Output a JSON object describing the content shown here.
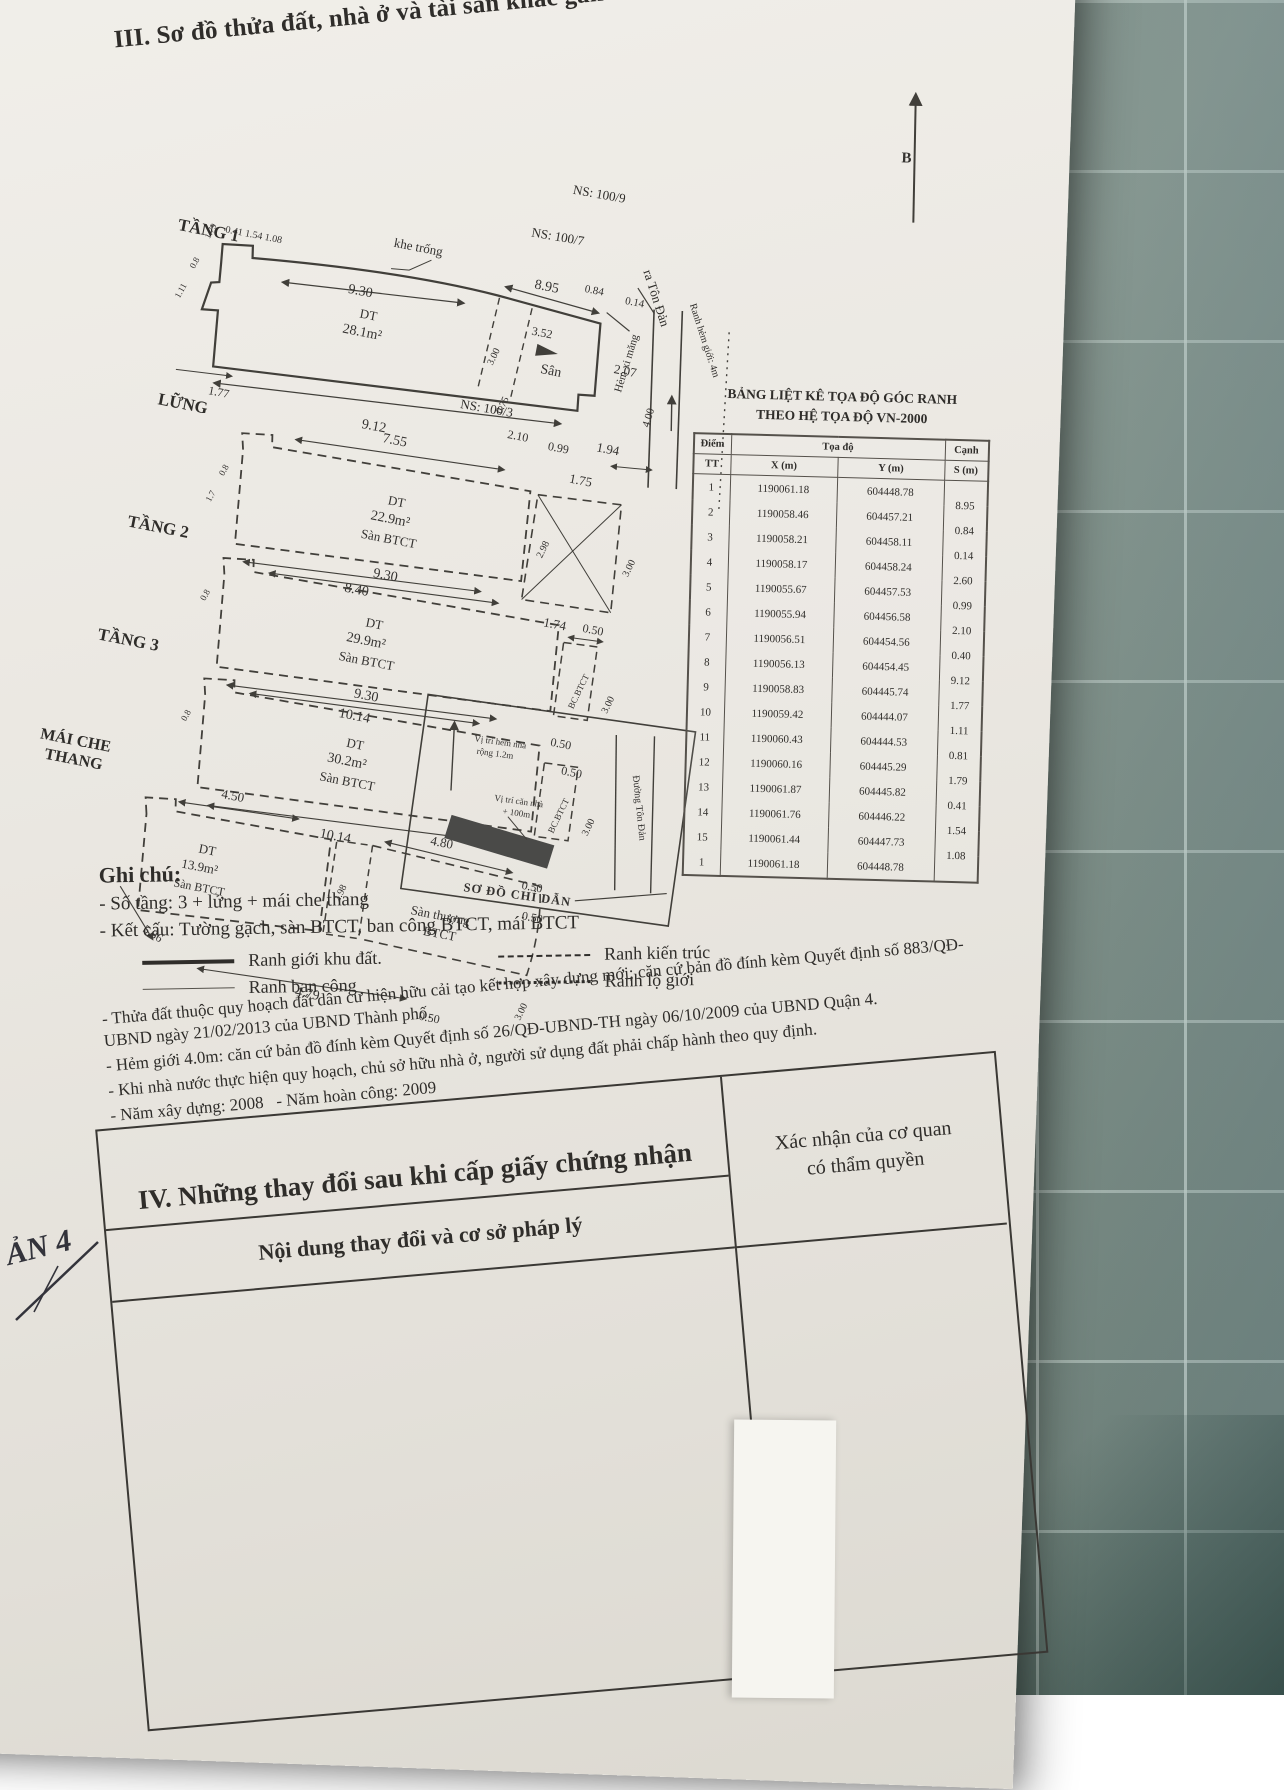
{
  "header": {
    "title": "III. Sơ đồ thửa đất, nhà ở và tài sản khác gắn liền với đất",
    "north_label": "B"
  },
  "site": {
    "khe_trong": "khe trống",
    "ns_100_9": "NS: 100/9",
    "ns_100_7": "NS: 100/7",
    "ns_100_3": "NS: 100/3",
    "ra_ton_dan": "ra Tôn Đản",
    "ranh_hem": "Ranh hẻm giới: 4m",
    "hem_xi_mang": "Hẻm xi măng",
    "hem_width": "4.00"
  },
  "floors": [
    {
      "name": "TẦNG 1",
      "dt": "DT",
      "area": "28.1m²",
      "dims": {
        "jog": "0.41  1.54  1.08",
        "top_a": "9.30",
        "top_b": "8.95",
        "left_a": "1.79",
        "left_b": "0.8",
        "left_c": "1.11",
        "left_d": "1.77",
        "bottom": "9.12",
        "san": "Sân",
        "r352": "3.52",
        "r084": "0.84",
        "r014": "0.14",
        "r207": "2.07",
        "r300": "3.00",
        "r075": "0.75",
        "r210": "2.10",
        "r099": "0.99",
        "r194": "1.94"
      }
    },
    {
      "name": "LỮNG",
      "dt": "DT",
      "area": "22.9m²",
      "slab": "Sàn BTCT",
      "dims": {
        "top": "7.55",
        "r175": "1.75",
        "r298": "2.98",
        "r300": "3.00",
        "r174": "1.74",
        "bottom": "8.40",
        "left_a": "0.8",
        "left_b": "1.7"
      }
    },
    {
      "name": "TẦNG 2",
      "dt": "DT",
      "area": "29.9m²",
      "slab": "Sàn BTCT",
      "dims": {
        "top": "9.30",
        "r050": "0.50",
        "bc": "BC.BTCT",
        "r300": "3.00",
        "bottom": "10.14",
        "left_a": "0.8"
      }
    },
    {
      "name": "TẦNG 3",
      "dt": "DT",
      "area": "30.2m²",
      "slab": "Sàn BTCT",
      "dims": {
        "top": "9.30",
        "r050a": "0.50",
        "r050b": "0.50",
        "bc": "BC.BTCT",
        "r300": "3.00",
        "bottom": "10.14",
        "left_a": "0.8"
      }
    },
    {
      "name": "MÁI CHE THANG",
      "name_l1": "MÁI CHE",
      "name_l2": "THANG",
      "dt": "DT",
      "area": "13.9m²",
      "slab": "Sàn BTCT",
      "terrace_l1": "Sàn thượng",
      "terrace_l2": "BTCT",
      "dims": {
        "top": "4.50",
        "mid": "4.80",
        "r050a": "0.50",
        "r050b": "0.50",
        "shaft": "2.98",
        "left": "5.36",
        "bottom": "4.79",
        "bottom_b": "0.50",
        "r300": "3.00"
      }
    }
  ],
  "inset": {
    "caption": "SƠ ĐỒ CHỈ DẪN",
    "street": "Đường Tôn Đản",
    "note_alley_l1": "Vị trí hẻm nhà",
    "note_alley_l2": "rộng 1.2m",
    "note_house_l1": "Vị trí căn nhà",
    "note_house_l2": "+ 100m"
  },
  "coord_table": {
    "title_l1": "BẢNG LIỆT KÊ TỌA ĐỘ GÓC RANH",
    "title_l2": "THEO HỆ TỌA ĐỘ VN-2000",
    "col_point": "Điểm",
    "col_coord": "Tọa độ",
    "col_edge": "Cạnh",
    "col_tt": "TT",
    "col_x": "X (m)",
    "col_y": "Y (m)",
    "col_s": "S (m)",
    "rows": [
      {
        "tt": "1",
        "x": "1190061.18",
        "y": "604448.78",
        "s": "8.95"
      },
      {
        "tt": "2",
        "x": "1190058.46",
        "y": "604457.21",
        "s": "0.84"
      },
      {
        "tt": "3",
        "x": "1190058.21",
        "y": "604458.11",
        "s": "0.14"
      },
      {
        "tt": "4",
        "x": "1190058.17",
        "y": "604458.24",
        "s": "2.60"
      },
      {
        "tt": "5",
        "x": "1190055.67",
        "y": "604457.53",
        "s": "0.99"
      },
      {
        "tt": "6",
        "x": "1190055.94",
        "y": "604456.58",
        "s": "2.10"
      },
      {
        "tt": "7",
        "x": "1190056.51",
        "y": "604454.56",
        "s": "0.40"
      },
      {
        "tt": "8",
        "x": "1190056.13",
        "y": "604454.45",
        "s": "9.12"
      },
      {
        "tt": "9",
        "x": "1190058.83",
        "y": "604445.74",
        "s": "1.77"
      },
      {
        "tt": "10",
        "x": "1190059.42",
        "y": "604444.07",
        "s": "1.11"
      },
      {
        "tt": "11",
        "x": "1190060.43",
        "y": "604444.53",
        "s": "0.81"
      },
      {
        "tt": "12",
        "x": "1190060.16",
        "y": "604445.29",
        "s": "1.79"
      },
      {
        "tt": "13",
        "x": "1190061.87",
        "y": "604445.82",
        "s": "0.41"
      },
      {
        "tt": "14",
        "x": "1190061.76",
        "y": "604446.22",
        "s": "1.54"
      },
      {
        "tt": "15",
        "x": "1190061.44",
        "y": "604447.73",
        "s": "1.08"
      },
      {
        "tt": "1",
        "x": "1190061.18",
        "y": "604448.78",
        "s": ""
      }
    ]
  },
  "notes": {
    "title": "Ghi chú:",
    "line_floors": "- Số tầng: 3 + lửng + mái che thang",
    "line_structure": "- Kết cấu: Tường gạch, sàn BTCT, ban công BTCT, mái BTCT",
    "legend": {
      "boundary": "Ranh giới khu đất.",
      "architecture": "Ranh kiến trúc",
      "balcony": "Ranh ban công",
      "road": "Ranh lộ giới"
    },
    "para_zoning": "- Thửa đất thuộc quy hoạch đất dân cư hiện hữu cải tạo kết hợp xây dựng mới; căn cứ bản đồ đính kèm Quyết định số 883/QĐ-UBND ngày 21/02/2013 của UBND Thành phố.",
    "para_alley": "- Hẻm giới 4.0m: căn cứ bản đồ đính kèm Quyết định số 26/QĐ-UBND-TH ngày 06/10/2009 của UBND Quận 4.",
    "para_comply": "- Khi nhà nước thực hiện quy hoạch, chủ sở hữu nhà ở, người sử dụng đất phải chấp hành theo quy định.",
    "para_year": "- Năm xây dựng: 2008   - Năm hoàn công: 2009"
  },
  "section4": {
    "title": "IV. Những thay đổi sau khi cấp giấy chứng nhận",
    "confirm_l1": "Xác nhận của cơ quan",
    "confirm_l2": "có thẩm quyền",
    "content_header": "Nội dung thay đổi và cơ sở pháp lý"
  },
  "handwriting": "ẢN 4"
}
